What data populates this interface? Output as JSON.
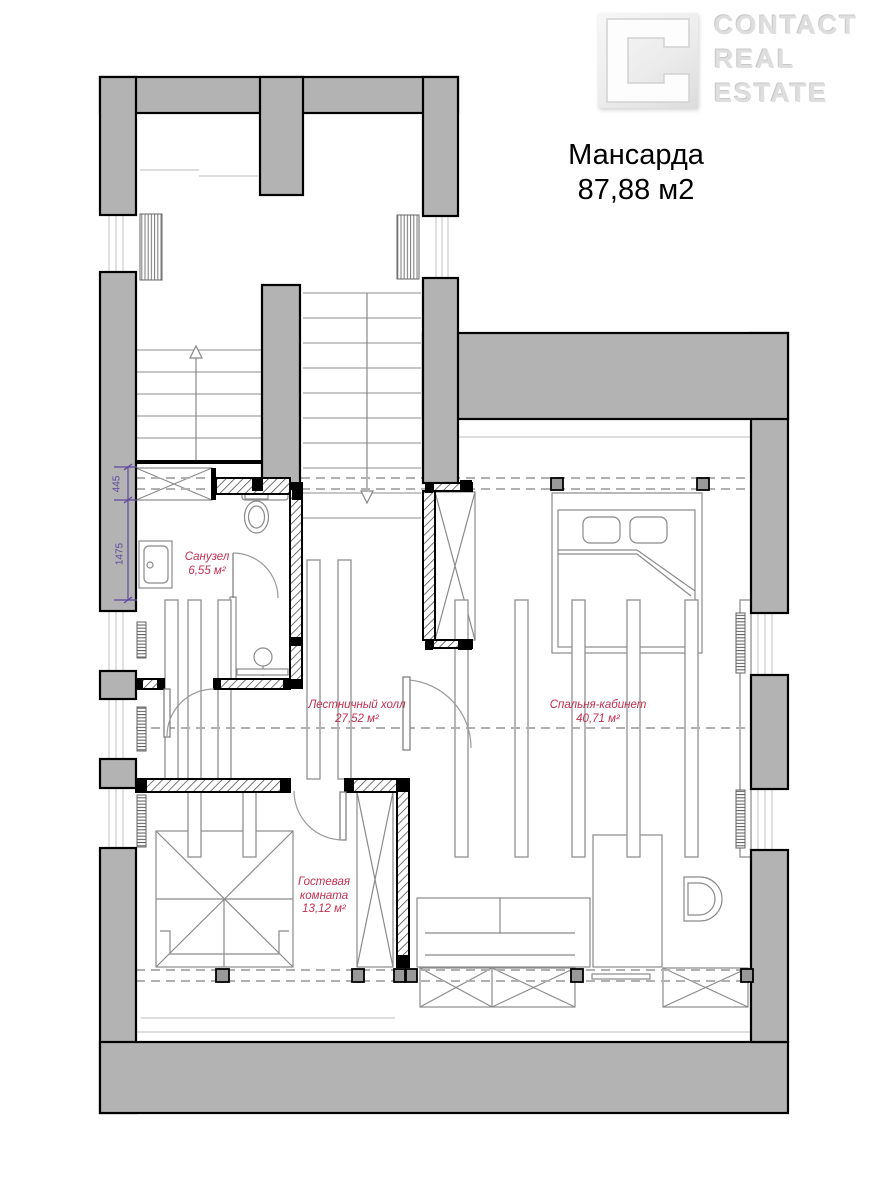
{
  "header": {
    "logo": {
      "mark": "contact-square-logo",
      "word1": "CONTACT",
      "word2": "REAL",
      "word3": "ESTATE"
    },
    "title_line1": "Мансарда",
    "title_line2": "87,88 м2"
  },
  "plan": {
    "rooms": {
      "bathroom": {
        "name": "Санузел",
        "area": "6,55 м²"
      },
      "stair_hall": {
        "name": "Лестничный холл",
        "area": "27,52 м²"
      },
      "bedroom_office": {
        "name": "Спальня-кабинет",
        "area": "40,71 м²"
      },
      "guest_room": {
        "name_line1": "Гостевая",
        "name_line2": "комната",
        "area": "13,12 м²"
      }
    },
    "dimensions": {
      "closet_depth": "445",
      "bathroom_length": "1475"
    },
    "colors": {
      "wall_fill": "#b3b3b3",
      "outline": "#000000",
      "room_label": "#c22f50",
      "dimension": "#5f48a0",
      "logo_gray": "#dedede"
    }
  }
}
